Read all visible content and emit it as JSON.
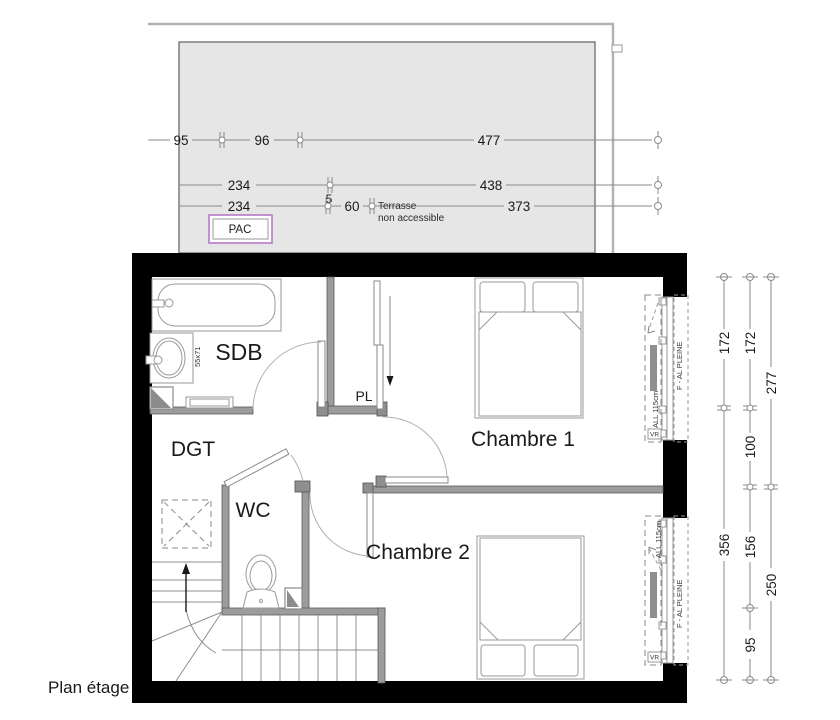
{
  "title": "Plan étage",
  "terrace": {
    "note_line1": "Terrasse",
    "note_line2": "non accessible",
    "pac_label": "PAC",
    "dims": {
      "row1": [
        "95",
        "96",
        "477"
      ],
      "row2": [
        "234",
        "438"
      ],
      "row2_gap": "5",
      "row3": [
        "234",
        "60",
        "373"
      ]
    }
  },
  "rooms": {
    "sdb": "SDB",
    "dgt": "DGT",
    "wc": "WC",
    "pl": "PL",
    "chambre1": "Chambre 1",
    "chambre2": "Chambre 2"
  },
  "fixtures": {
    "sink_dimensions": "55x71"
  },
  "windows": {
    "chambre1": {
      "sill_height": "ALL 115cm",
      "type": "F - AL PLEINE",
      "shutter": "VR"
    },
    "chambre2": {
      "sill_height": "ALL 115cm",
      "type": "F - AL PLEINE",
      "shutter": "VR"
    }
  },
  "dims_right": {
    "col1": [
      "172",
      "356"
    ],
    "col2": [
      "172",
      "100",
      "156",
      "95"
    ],
    "col3": [
      "277",
      "250"
    ]
  },
  "colors": {
    "terrace_fill": "#e6e6e6",
    "wall": "#000000",
    "partition": "#9c9c9c",
    "pac_border": "#b678c8",
    "dim_line": "#8a8a8a"
  }
}
